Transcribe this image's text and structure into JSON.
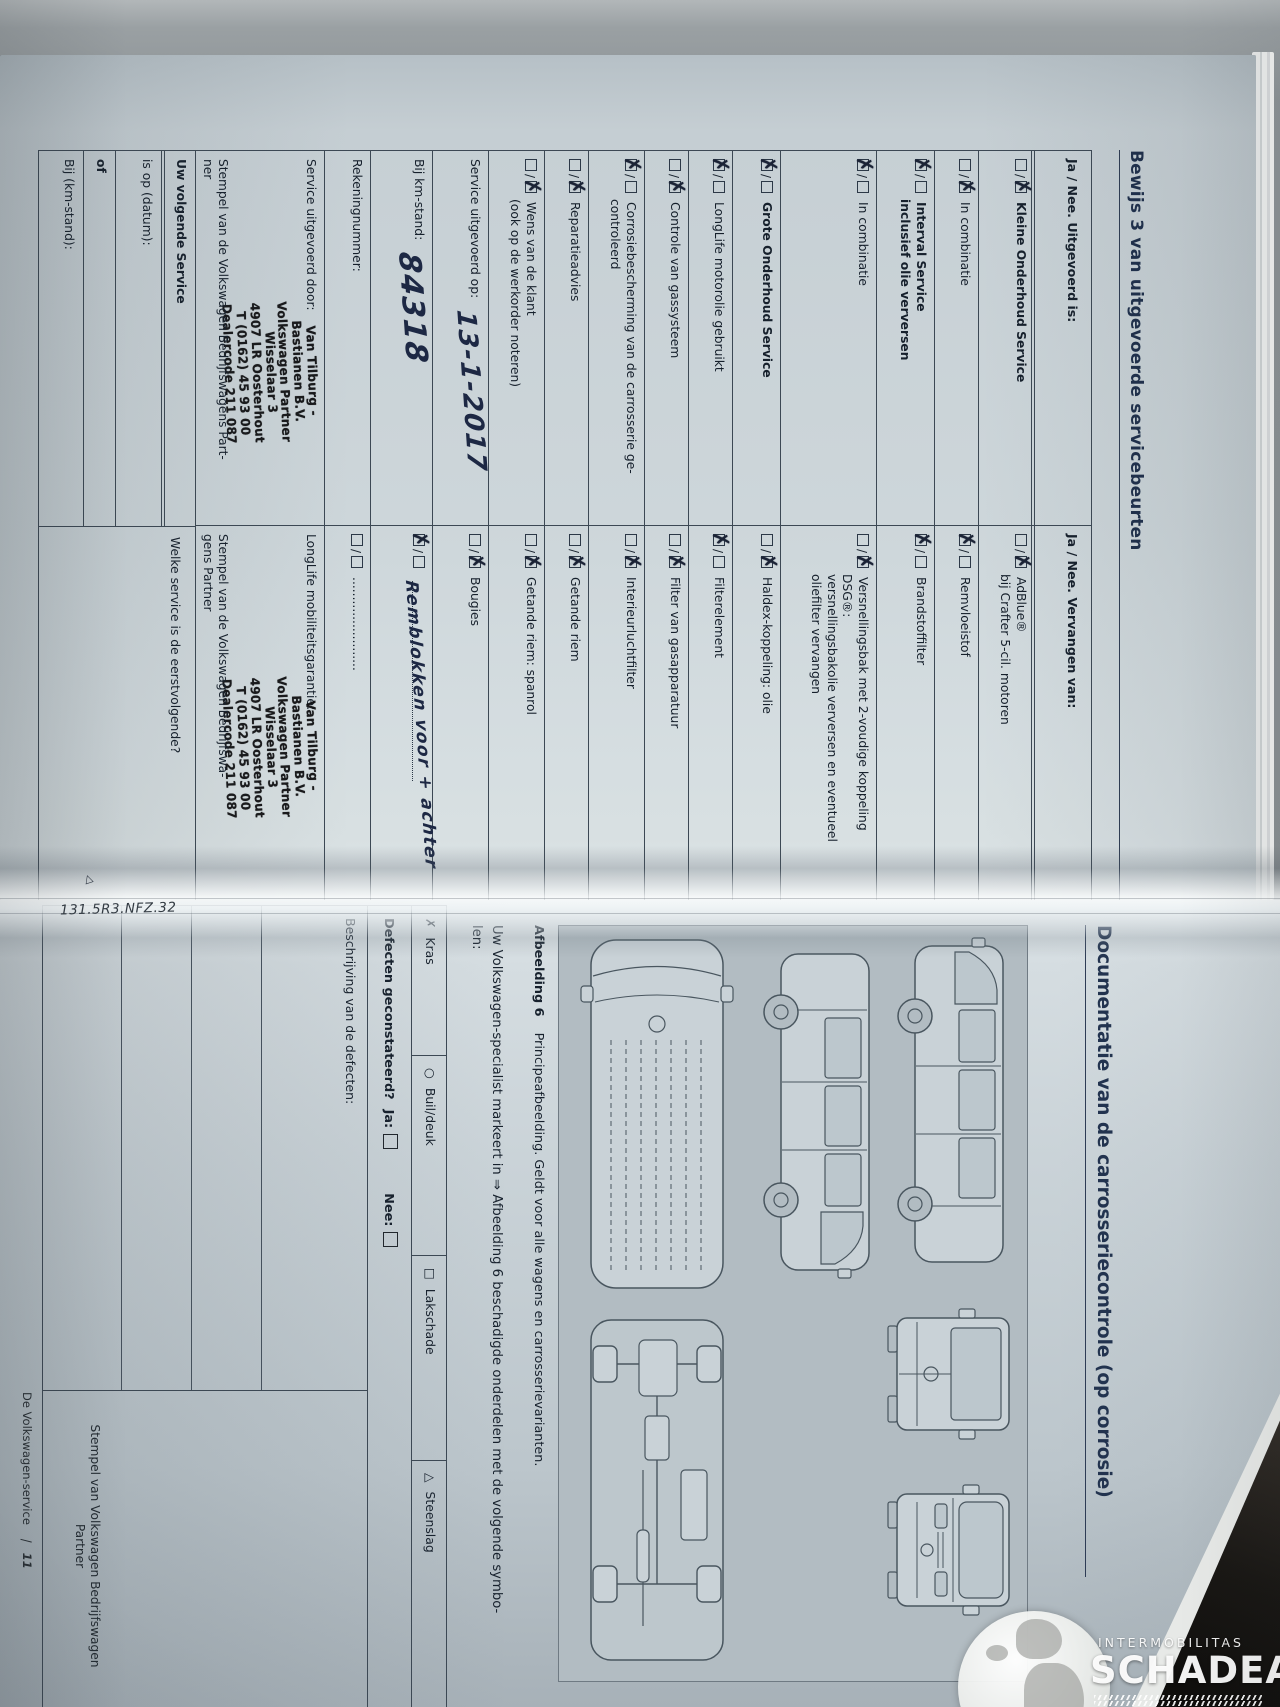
{
  "photo": {
    "code_label": "131.5R3.NFZ.32",
    "corner_marker": "△"
  },
  "watermark": {
    "brand_small": "INTERMOBILITAS",
    "brand_large": "SCHADEAUTOS.NL"
  },
  "left_page": {
    "title": "Bewijs 3 van uitgevoerde servicebeurten",
    "header_left": "Ja / Nee. Uitgevoerd is:",
    "header_right": "Ja / Nee. Vervangen van:",
    "rows": [
      {
        "h": 56,
        "l": {
          "m": 2,
          "lines": [
            [
              "Kleine Onderhoud Service",
              1
            ]
          ]
        },
        "r": {
          "m": 2,
          "lines": [
            [
              "AdBlue®",
              0
            ],
            [
              "bij Crafter 5-cil. motoren",
              0
            ]
          ]
        }
      },
      {
        "h": 44,
        "l": {
          "m": 2,
          "lines": [
            [
              "In combinatie",
              0
            ]
          ]
        },
        "r": {
          "m": 1,
          "lines": [
            [
              "Remvloeistof",
              0
            ]
          ]
        }
      },
      {
        "h": 58,
        "l": {
          "m": 1,
          "lines": [
            [
              "Interval Service",
              1
            ],
            [
              "inclusief olie verversen",
              1
            ]
          ]
        },
        "r": {
          "m": 1,
          "lines": [
            [
              "Brandstoffilter",
              0
            ]
          ]
        }
      },
      {
        "h": 96,
        "l": {
          "m": 1,
          "lines": [
            [
              "In combinatie",
              0
            ]
          ]
        },
        "r": {
          "m": 2,
          "lines": [
            [
              "Versnellingsbak met 2-voudige koppeling",
              0
            ],
            [
              "DSG®:",
              0
            ],
            [
              "versnellingsbakolie verversen en eventueel",
              0
            ],
            [
              "oliefilter vervangen",
              0
            ]
          ]
        }
      },
      {
        "h": 48,
        "l": {
          "m": 1,
          "lines": [
            [
              "Grote Onderhoud Service",
              1
            ]
          ]
        },
        "r": {
          "m": 2,
          "lines": [
            [
              "Haldex-koppeling: olie",
              0
            ]
          ]
        }
      },
      {
        "h": 44,
        "l": {
          "m": 1,
          "lines": [
            [
              "LongLife motorolie gebruikt",
              0
            ]
          ]
        },
        "r": {
          "m": 1,
          "lines": [
            [
              "Filterelement",
              0
            ]
          ]
        }
      },
      {
        "h": 44,
        "l": {
          "m": 2,
          "lines": [
            [
              "Controle van gassysteem",
              0
            ]
          ]
        },
        "r": {
          "m": 2,
          "lines": [
            [
              "Filter van gasapparatuur",
              0
            ]
          ]
        }
      },
      {
        "h": 56,
        "l": {
          "m": 1,
          "lines": [
            [
              "Corrosiebescherming van de carrosserie ge-",
              0
            ],
            [
              "controleerd",
              0
            ]
          ]
        },
        "r": {
          "m": 2,
          "lines": [
            [
              "Interieurluchtfilter",
              0
            ]
          ]
        }
      },
      {
        "h": 44,
        "l": {
          "m": 2,
          "lines": [
            [
              "Reparatieadvies",
              0
            ]
          ]
        },
        "r": {
          "m": 2,
          "lines": [
            [
              "Getande riem",
              0
            ]
          ]
        }
      },
      {
        "h": 56,
        "l": {
          "m": 2,
          "lines": [
            [
              "Wens van de klant",
              0
            ],
            [
              "(ook op de werkorder noteren)",
              0
            ]
          ]
        },
        "r": {
          "m": 2,
          "lines": [
            [
              "Getande riem: spanrol",
              0
            ]
          ]
        }
      },
      {
        "h": 56,
        "l": {
          "m": -1,
          "lines": [
            [
              "Service uitgevoerd op:",
              0
            ]
          ],
          "hw": "13-1-2017",
          "hwsize": 26
        },
        "r": {
          "m": 2,
          "lines": [
            [
              "Bougies",
              0
            ]
          ]
        }
      },
      {
        "h": 62,
        "l": {
          "m": -1,
          "lines": [
            [
              "Bij km-stand:",
              0
            ]
          ],
          "hw": "84318",
          "hwsize": 30
        },
        "r": {
          "m": 1,
          "lines": [
            [
              "",
              0
            ]
          ],
          "dots": true,
          "hw": "Remblokken voor + achter",
          "hwsize": 17
        }
      },
      {
        "h": 46,
        "l": {
          "m": -1,
          "lines": [
            [
              "Rekeningnummer:",
              0
            ]
          ]
        },
        "r": {
          "m": 0,
          "lines": [
            [
              "........................",
              0
            ]
          ]
        }
      }
    ],
    "row14": {
      "left_label": "Service uitgevoerd door:",
      "right_label": "LongLife mobiliteitsgarantie:",
      "left_caption": "Stempel van de Volkswagen Bedrijfswagens Part-\nner",
      "right_caption": "Stempel van de Volkswagen Bedrijfswa-\ngens Partner"
    },
    "stamp_lines": [
      "Van Tilburg -",
      "Bastianen B.V.",
      "Volkswagen Partner",
      "Wisselaar 3",
      "4907 LR Oosterhout",
      "T (0162) 45 93 00",
      "Dealercode 211 087"
    ],
    "next_service": {
      "header": "Uw volgende Service",
      "date_label": "is op (datum):",
      "or_label": "of",
      "km_label": "Bij (km-stand):",
      "question": "Welke service is de eerstvolgende?"
    }
  },
  "right_page": {
    "title": "Documentatie van de carrosseriecontrole (op corrosie)",
    "caption_bold": "Afbeelding 6",
    "caption_rest": "Principeafbeelding. Geldt voor alle wagens en carrosserievarianten.",
    "intro_line1": "Uw Volkswagen-specialist markeert in ⇒ Afbeelding 6 beschadigde onderdelen met de volgende symbo-",
    "intro_line2": "len:",
    "legend": [
      {
        "sym": "✗",
        "label": "Kras"
      },
      {
        "sym": "○",
        "label": "Buil/deuk"
      },
      {
        "sym": "□",
        "label": "Lakschade"
      },
      {
        "sym": "△",
        "label": "Steenslag"
      }
    ],
    "defects": {
      "question": "Defecten geconstateerd?",
      "yes": "Ja:",
      "no": "Nee:"
    },
    "description_label": "Beschrijving van de defecten:",
    "stamp_caption": "Stempel van Volkswagen Bedrijfswagen\nPartner",
    "footer": {
      "text": "De Volkswagen-service",
      "page": "11"
    }
  }
}
